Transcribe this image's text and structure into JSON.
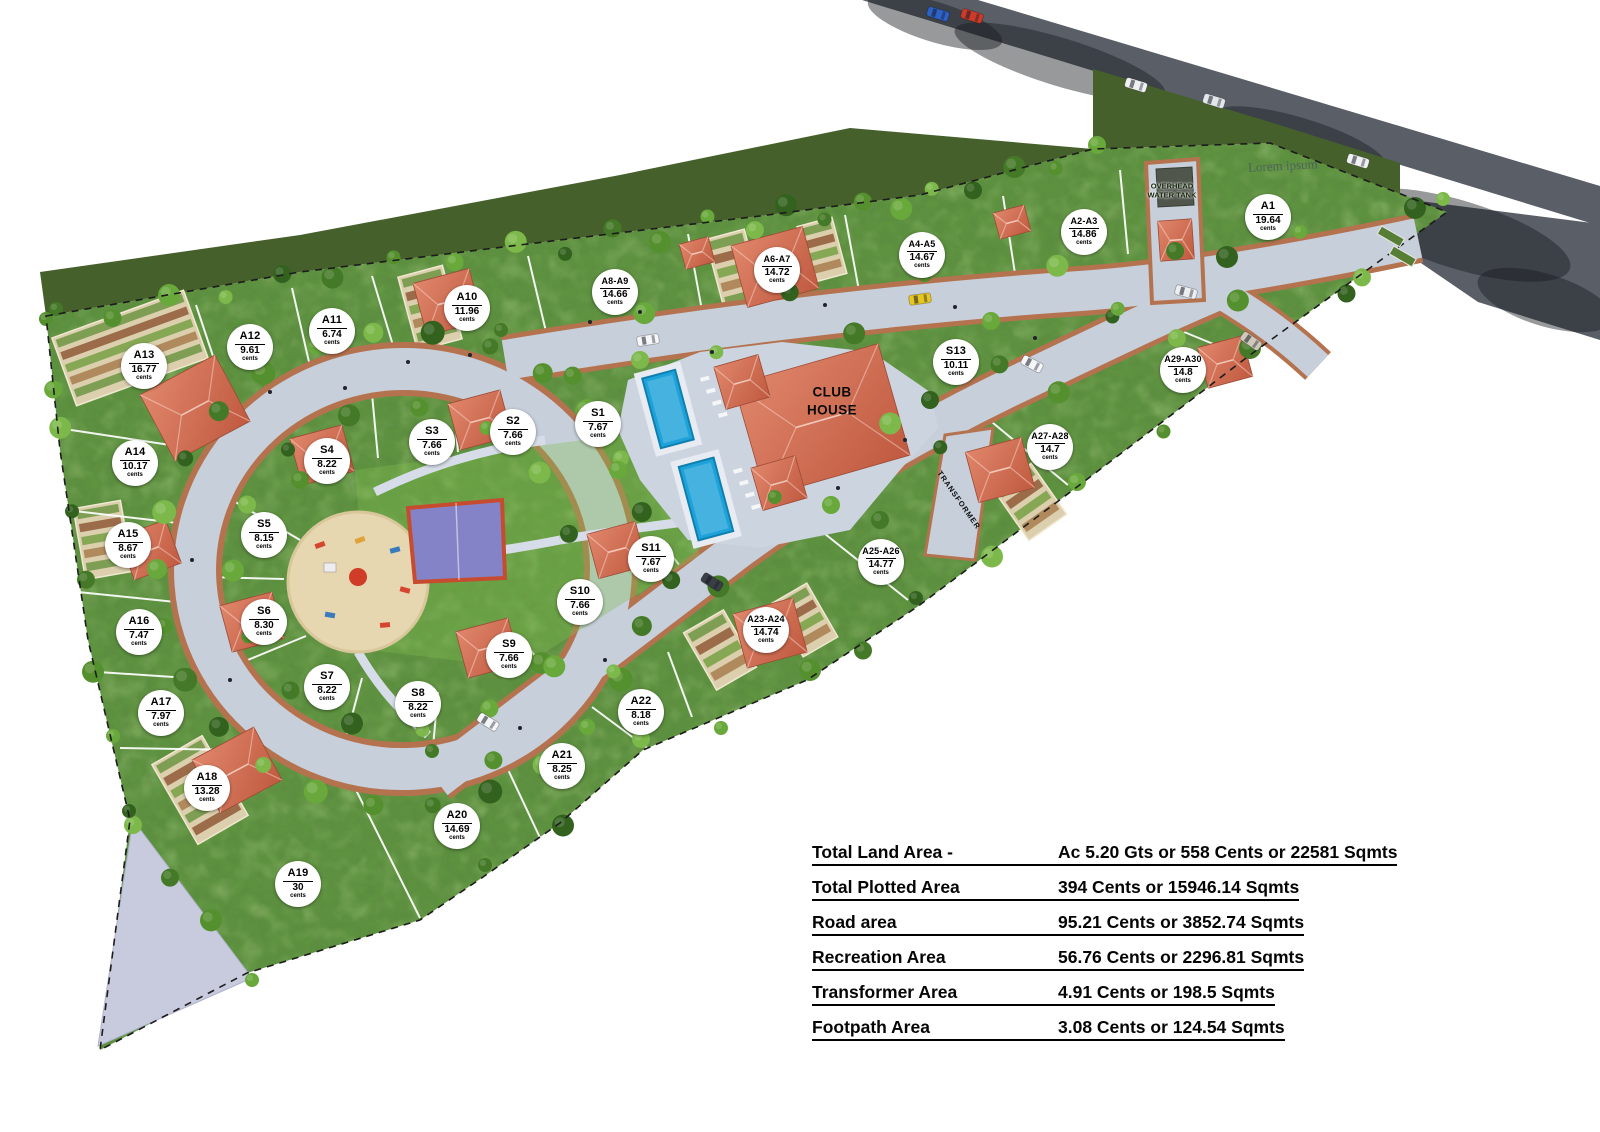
{
  "map": {
    "labels": {
      "club_house_line1": "CLUB",
      "club_house_line2": "HOUSE",
      "water_tank_line1": "OVERHEAD",
      "water_tank_line2": "WATER TANK",
      "transformer": "TRANSFORMER",
      "watermark": "Lorem ipsum"
    },
    "unit_label": "cents",
    "plots": [
      {
        "id": "A1",
        "area": "19.64",
        "unit": "cents",
        "x": 1268,
        "y": 217
      },
      {
        "id": "A2-A3",
        "area": "14.86",
        "unit": "cents",
        "x": 1084,
        "y": 232
      },
      {
        "id": "A4-A5",
        "area": "14.67",
        "unit": "cents",
        "x": 922,
        "y": 255
      },
      {
        "id": "A6-A7",
        "area": "14.72",
        "unit": "cents",
        "x": 777,
        "y": 270
      },
      {
        "id": "A8-A9",
        "area": "14.66",
        "unit": "cents",
        "x": 615,
        "y": 292
      },
      {
        "id": "A10",
        "area": "11.96",
        "unit": "cents",
        "x": 467,
        "y": 308
      },
      {
        "id": "A11",
        "area": "6.74",
        "unit": "cents",
        "x": 332,
        "y": 331
      },
      {
        "id": "A12",
        "area": "9.61",
        "unit": "cents",
        "x": 250,
        "y": 347
      },
      {
        "id": "A13",
        "area": "16.77",
        "unit": "cents",
        "x": 144,
        "y": 366
      },
      {
        "id": "A14",
        "area": "10.17",
        "unit": "cents",
        "x": 135,
        "y": 463
      },
      {
        "id": "A15",
        "area": "8.67",
        "unit": "cents",
        "x": 128,
        "y": 545
      },
      {
        "id": "A16",
        "area": "7.47",
        "unit": "cents",
        "x": 139,
        "y": 632
      },
      {
        "id": "A17",
        "area": "7.97",
        "unit": "cents",
        "x": 161,
        "y": 713
      },
      {
        "id": "A18",
        "area": "13.28",
        "unit": "cents",
        "x": 207,
        "y": 788
      },
      {
        "id": "A19",
        "area": "30",
        "unit": "cents",
        "x": 298,
        "y": 884
      },
      {
        "id": "A20",
        "area": "14.69",
        "unit": "cents",
        "x": 457,
        "y": 826
      },
      {
        "id": "A21",
        "area": "8.25",
        "unit": "cents",
        "x": 562,
        "y": 766
      },
      {
        "id": "A22",
        "area": "8.18",
        "unit": "cents",
        "x": 641,
        "y": 712
      },
      {
        "id": "A23-A24",
        "area": "14.74",
        "unit": "cents",
        "x": 766,
        "y": 630
      },
      {
        "id": "A25-A26",
        "area": "14.77",
        "unit": "cents",
        "x": 881,
        "y": 562
      },
      {
        "id": "A27-A28",
        "area": "14.7",
        "unit": "cents",
        "x": 1050,
        "y": 447
      },
      {
        "id": "A29-A30",
        "area": "14.8",
        "unit": "cents",
        "x": 1183,
        "y": 370
      },
      {
        "id": "S1",
        "area": "7.67",
        "unit": "cents",
        "x": 598,
        "y": 424
      },
      {
        "id": "S2",
        "area": "7.66",
        "unit": "cents",
        "x": 513,
        "y": 432
      },
      {
        "id": "S3",
        "area": "7.66",
        "unit": "cents",
        "x": 432,
        "y": 442
      },
      {
        "id": "S4",
        "area": "8.22",
        "unit": "cents",
        "x": 327,
        "y": 461
      },
      {
        "id": "S5",
        "area": "8.15",
        "unit": "cents",
        "x": 264,
        "y": 535
      },
      {
        "id": "S6",
        "area": "8.30",
        "unit": "cents",
        "x": 264,
        "y": 622
      },
      {
        "id": "S7",
        "area": "8.22",
        "unit": "cents",
        "x": 327,
        "y": 687
      },
      {
        "id": "S8",
        "area": "8.22",
        "unit": "cents",
        "x": 418,
        "y": 704
      },
      {
        "id": "S9",
        "area": "7.66",
        "unit": "cents",
        "x": 509,
        "y": 655
      },
      {
        "id": "S10",
        "area": "7.66",
        "unit": "cents",
        "x": 580,
        "y": 602
      },
      {
        "id": "S11",
        "area": "7.67",
        "unit": "cents",
        "x": 651,
        "y": 559
      },
      {
        "id": "S13",
        "area": "10.11",
        "unit": "cents",
        "x": 956,
        "y": 362
      }
    ]
  },
  "legend": {
    "rows": [
      {
        "label": "Total Land Area -",
        "value": "Ac 5.20 Gts or 558 Cents or 22581 Sqmts"
      },
      {
        "label": "Total Plotted Area",
        "value": "394 Cents or 15946.14 Sqmts"
      },
      {
        "label": "Road area",
        "value": "95.21 Cents or 3852.74 Sqmts"
      },
      {
        "label": "Recreation Area",
        "value": "56.76 Cents or 2296.81 Sqmts"
      },
      {
        "label": "Transformer Area",
        "value": "4.91 Cents or 198.5 Sqmts"
      },
      {
        "label": "Footpath Area",
        "value": "3.08 Cents or 124.54 Sqmts"
      }
    ]
  },
  "colors": {
    "site_green": "#5e9340",
    "outside_green": "#46602c",
    "road_concrete": "#c6cfda",
    "road_edge": "#b5724f",
    "asphalt": "#5a5e66",
    "pool": "#1ea2da",
    "roof_light": "#e0866b",
    "roof_dark": "#c05a40",
    "court": "#8583c7",
    "court_border": "#c74b2f",
    "sand": "#e6d7b0",
    "pond": "#c8cade",
    "marker_bg": "#ffffff",
    "text": "#000000"
  }
}
